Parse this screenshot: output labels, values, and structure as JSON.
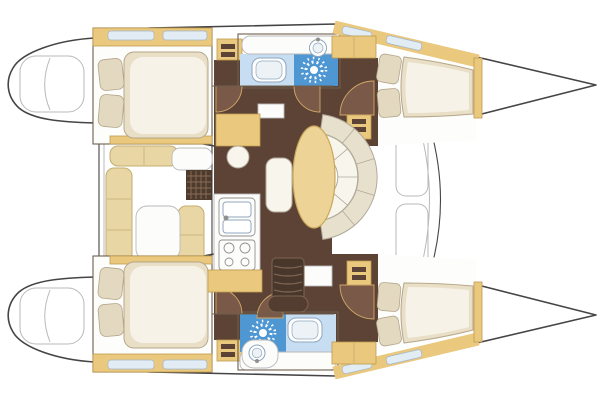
{
  "meta": {
    "subject": "Catamaran sailboat interior floor plan, top-down view, bow pointing right",
    "image_type": "boat layout diagram"
  },
  "inventory": {
    "double_berth_cabins": 4,
    "bathrooms": 2,
    "shower_units": 2,
    "toilets": 2,
    "bathroom_sinks": 2,
    "galley_burners": 4,
    "salon_dining_table": 1,
    "cockpit_table": 1,
    "nav_station_desk": 1,
    "companionway_stairs": 1,
    "door_swings": 6
  },
  "colors": {
    "outline": "#454545",
    "line_faint": "#b9b9b9",
    "wall": "#6e5f4d",
    "wood": "#eac87e",
    "wood_dark": "#bd9a4e",
    "floor_dark": "#5d4336",
    "floor_door": "#7b5948",
    "door_swing": "#cfa968",
    "mattress": "#e9dfc6",
    "mattress_edge": "#b4a68a",
    "duvet": "#f6f2e7",
    "pillow": "#e3d8c0",
    "cushion": "#e8d7a5",
    "cushion_edge": "#c3ac6e",
    "sofa_outer": "#e7e0cd",
    "sofa_inner": "#f8f5ed",
    "sofa_edge": "#b2aa99",
    "table": "#edd396",
    "table_edge": "#c9a75a",
    "bath_light": "#c7ddf1",
    "bath_shower": "#4e97d3",
    "fixture_edge": "#8fa6bd",
    "appliance_edge": "#909090",
    "tread": "#7c634f",
    "window": "#e2ecf4",
    "window_edge": "#a3b6c6"
  }
}
